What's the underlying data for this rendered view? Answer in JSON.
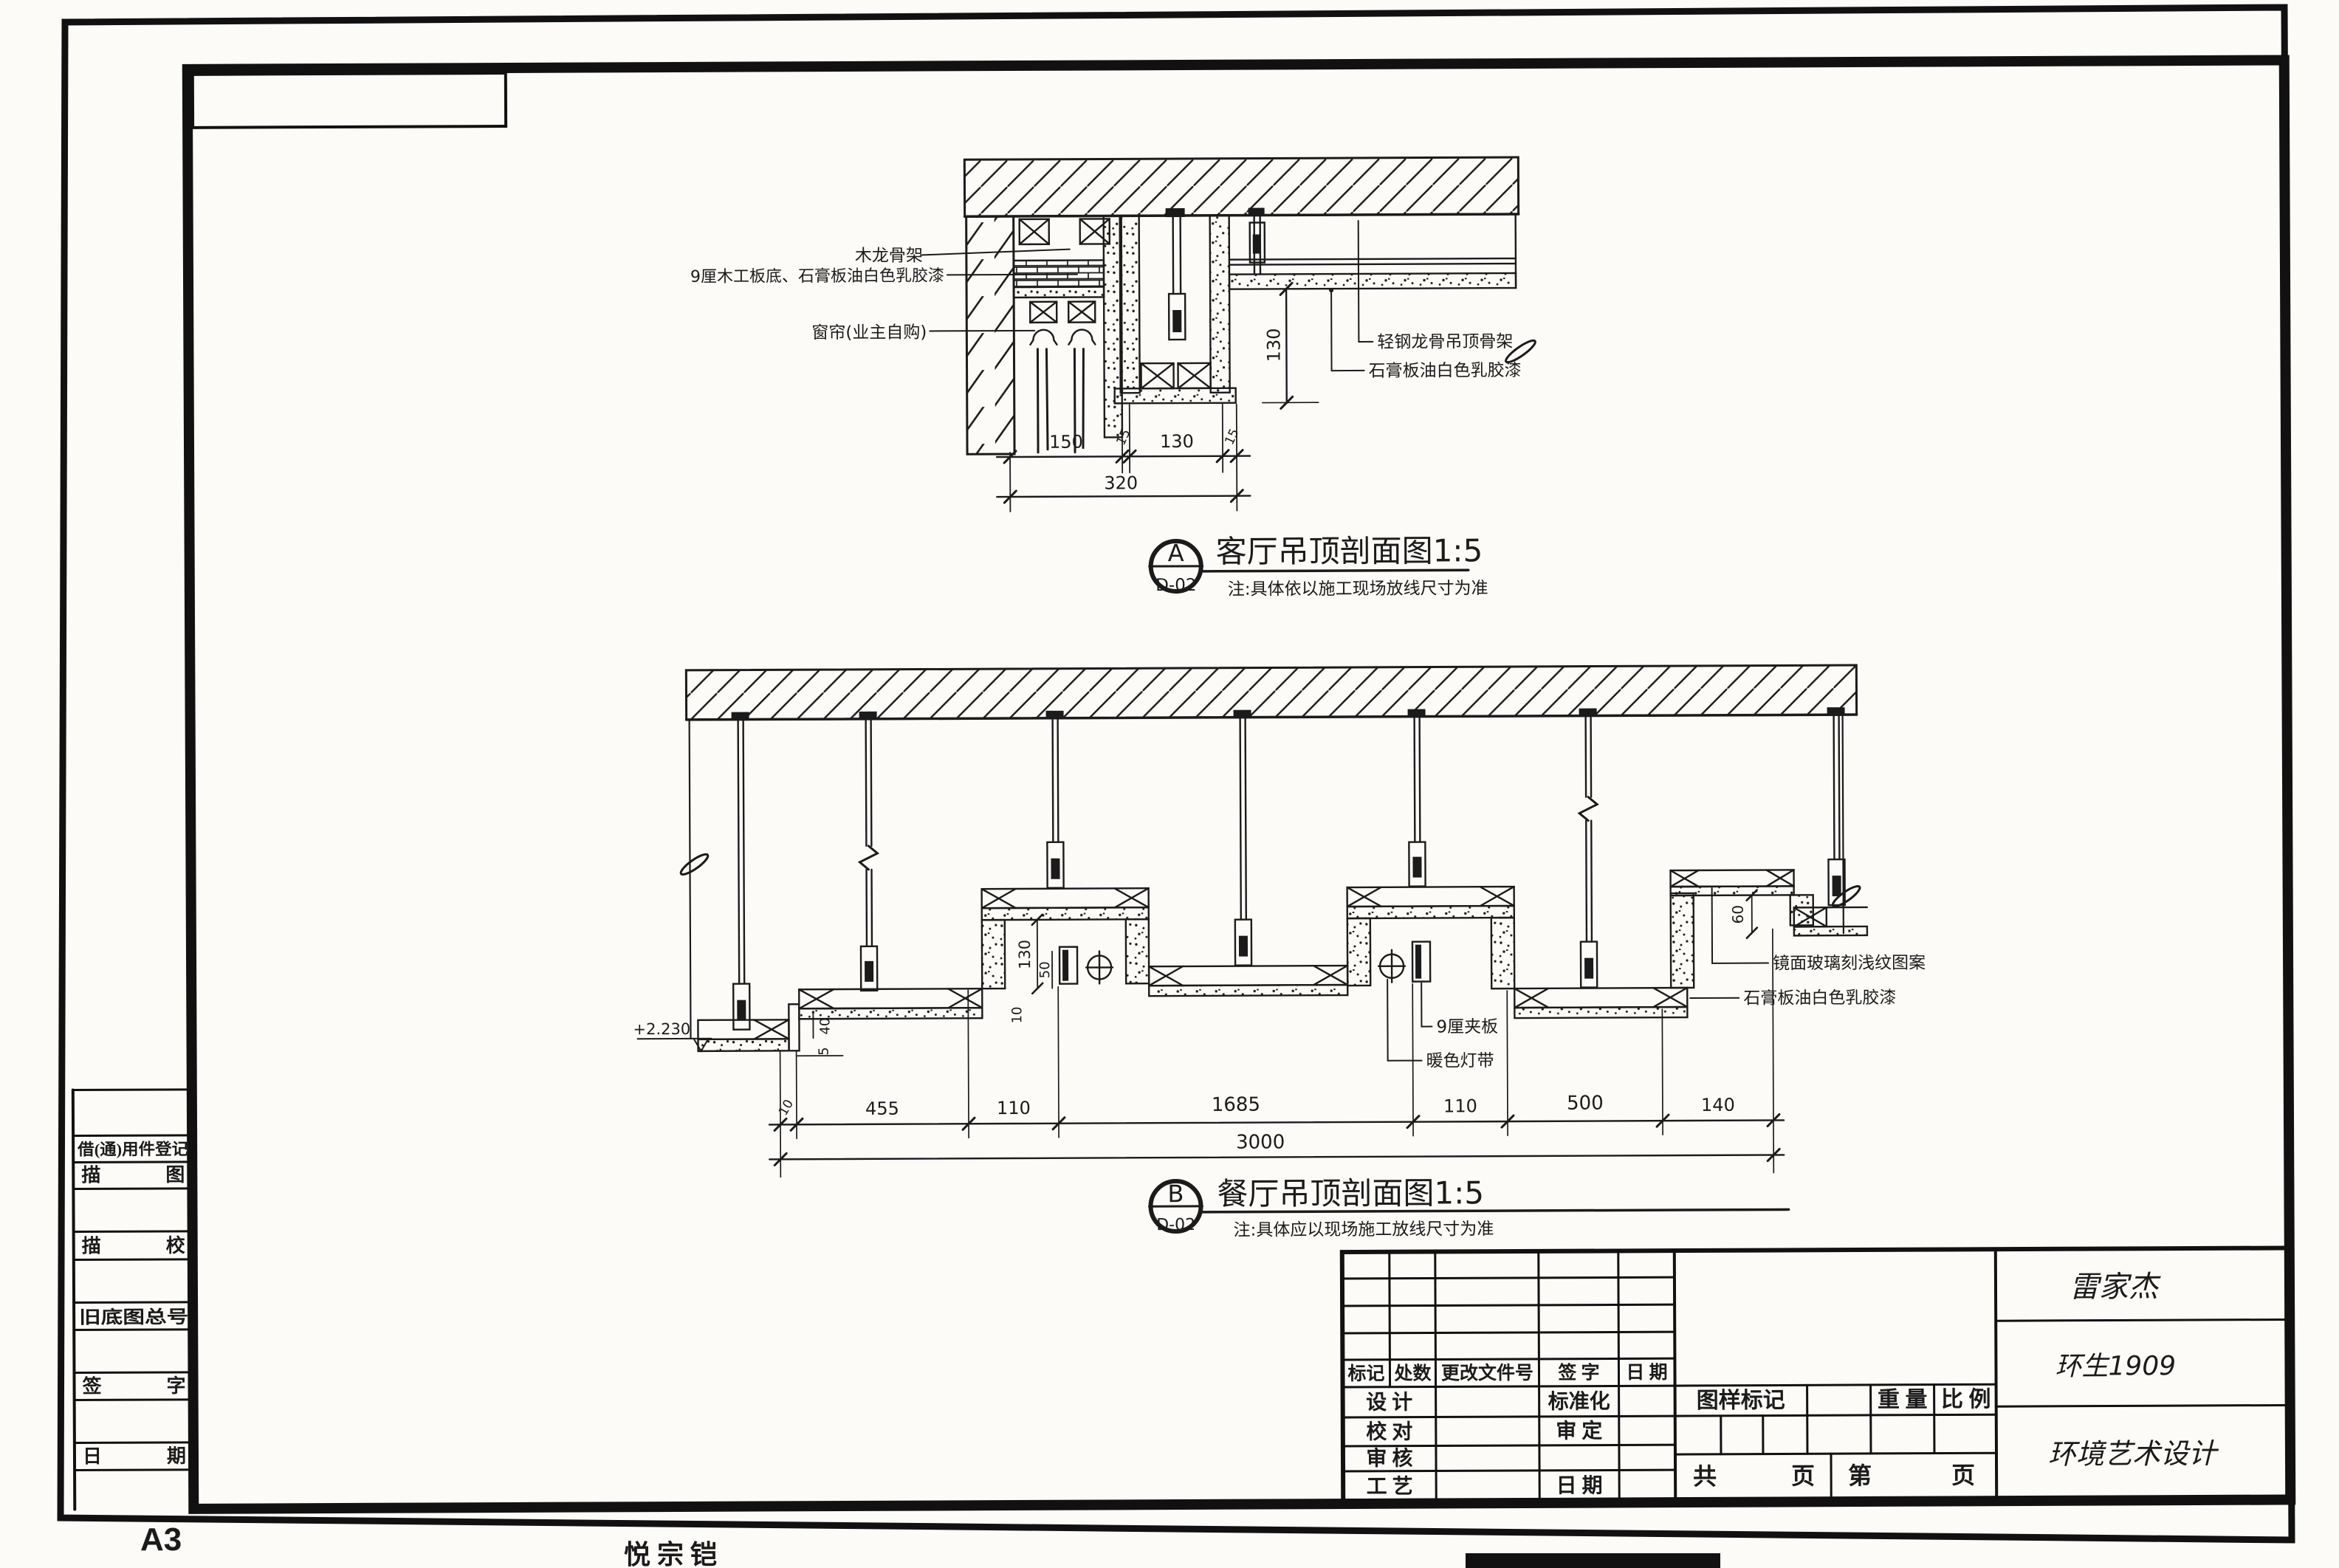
{
  "sheet": {
    "paper_size": "A3",
    "author": "悦 宗 铠"
  },
  "sidebar": {
    "items": [
      "借(通)用件登记",
      "描 图",
      "描 校",
      "旧底图总号",
      "签 字",
      "日 期"
    ]
  },
  "title_block": {
    "change_header": [
      "标记",
      "处数",
      "更改文件号",
      "签 字",
      "日 期"
    ],
    "roles": {
      "design": "设 计",
      "standardization": "标准化",
      "check": "校 对",
      "approve": "审 定",
      "review": "审 核",
      "process": "工 艺",
      "date": "日 期"
    },
    "stamp": {
      "drawing_mark": "图样标记",
      "weight": "重 量",
      "scale": "比 例",
      "total_label": "共",
      "total_pages_label": "页",
      "page_label": "第",
      "page_pages_label": "页"
    },
    "signatures": {
      "name": "雷家杰",
      "class": "环生1909",
      "major": "环境艺术设计"
    }
  },
  "detail_a": {
    "ref": "A",
    "sheet_no": "D-02",
    "title": "客厅吊顶剖面图1:5",
    "note": "注:具体依以施工现场放线尺寸为准",
    "labels": {
      "wood_keel": "木龙骨架",
      "plywood_base": "9厘木工板底、石膏板油白色乳胶漆",
      "curtain": "窗帘(业主自购)",
      "steel_keel": "轻钢龙骨吊顶骨架",
      "gypsum": "石膏板油白色乳胶漆"
    },
    "dims": {
      "d1": "150",
      "d2": "15",
      "d3": "130",
      "d4": "15",
      "total": "320",
      "height": "130"
    }
  },
  "detail_b": {
    "ref": "B",
    "sheet_no": "D-02",
    "title": "餐厅吊顶剖面图1:5",
    "note": "注:具体应以现场施工放线尺寸为准",
    "labels": {
      "plywood": "9厘夹板",
      "lamp": "暖色灯带",
      "mirror": "镜面玻璃刻浅纹图案",
      "gypsum": "石膏板油白色乳胶漆",
      "level": "+2.230"
    },
    "dims": {
      "chain": [
        "10",
        "455",
        "110",
        "1685",
        "110",
        "500",
        "140"
      ],
      "total": "3000",
      "v130": "130",
      "v50": "50",
      "v10": "10",
      "v40": "40",
      "v5": "5",
      "v60": "60"
    }
  }
}
